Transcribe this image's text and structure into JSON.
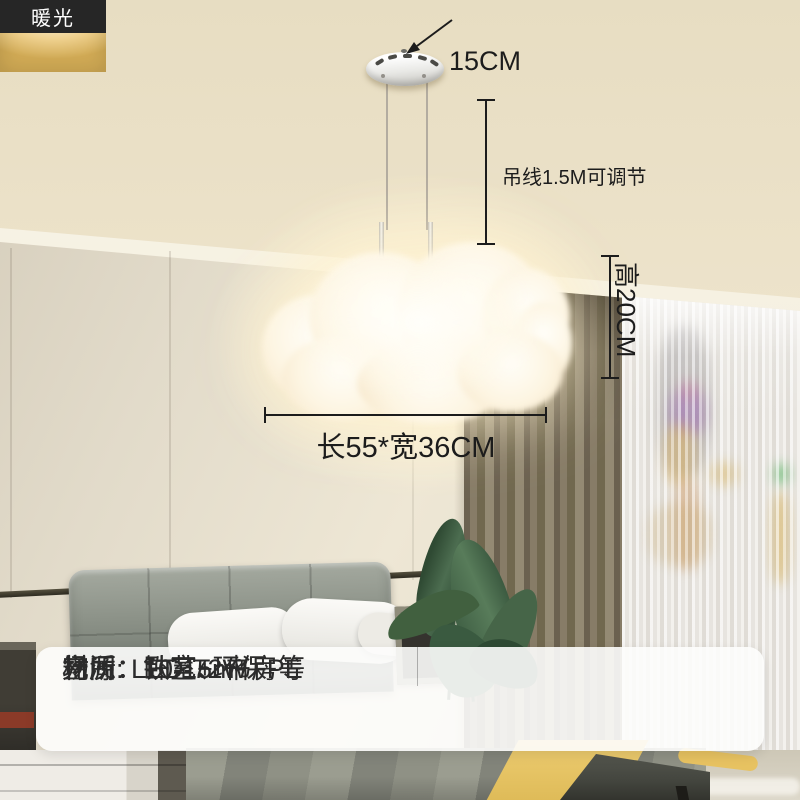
{
  "sidebar": {
    "options": [
      {
        "name": "white-light",
        "label": "白光",
        "color": "#c9c8c4"
      },
      {
        "name": "neutral-light",
        "label": "中性光",
        "color": "#e3cf9f"
      },
      {
        "name": "warm-light",
        "label": "暖光",
        "color": "#e8bd5e"
      }
    ]
  },
  "annotations": {
    "canopy_diameter": "15CM",
    "cord_length": "吊线1.5M可调节",
    "lamp_height": "高20CM",
    "lamp_size": "长55*宽36CM"
  },
  "spec_table": {
    "rows": [
      {
        "left": "材质：铁艺+环保PE",
        "right": "光源: LED-72W"
      },
      {
        "left": "空间：10-15m²",
        "right": "场所：卧室、书房等"
      }
    ]
  },
  "colors": {
    "annotation_text": "#1c1c1c",
    "option_label_bg": "#262626",
    "warm_glow": "#fff4da"
  }
}
